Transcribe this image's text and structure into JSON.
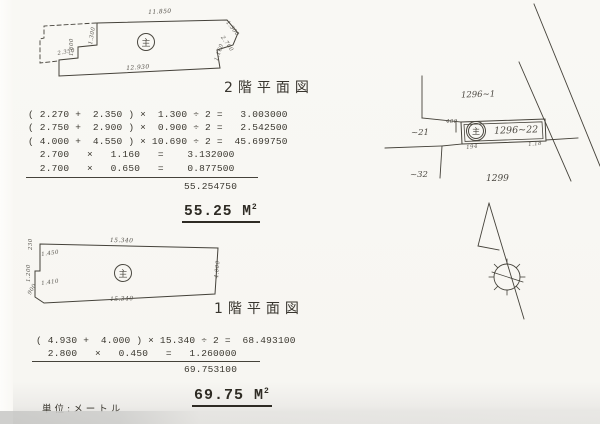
{
  "paper": {
    "bg": "#f8f7f3",
    "ink": "#45423a"
  },
  "plan_2f": {
    "title": "2階平面図",
    "circle_symbol": "主",
    "dim_top": "11.850",
    "dim_bottom": "12.930",
    "dim_left_steps": [
      "2.350",
      "1.600",
      "1.300"
    ],
    "dim_right": [
      "1.300",
      "2.700",
      "1.160"
    ]
  },
  "calc_2f": {
    "lines": [
      "( 2.270 +  2.350 ) ×  1.300 ÷ 2 =   3.003000",
      "( 2.750 +  2.900 ) ×  0.900 ÷ 2 =   2.542500",
      "( 4.000 +  4.550 ) × 10.690 ÷ 2 =  45.699750",
      "  2.700   ×   1.160   =    3.132000",
      "  2.700   ×   0.650   =    0.877500"
    ],
    "total": "55.254750",
    "area": "55.25 M",
    "area_sup": "2"
  },
  "plan_1f": {
    "title": "1階平面図",
    "circle_symbol": "主",
    "dim_top": "15.340",
    "dim_bottom": "15.340",
    "dim_right": "4.000",
    "dim_left_steps": [
      "230",
      "1.450",
      "1.200",
      "1.410",
      "900"
    ]
  },
  "calc_1f": {
    "lines": [
      "( 4.930 +  4.000 ) × 15.340 ÷ 2 =  68.493100",
      "  2.800   ×   0.450   =   1.260000"
    ],
    "total": "69.753100",
    "area": "69.75 M",
    "area_sup": "2"
  },
  "unit_note": "単位:メートル",
  "site_map": {
    "parcel_top": "1296~1",
    "parcel_left": "~21",
    "parcel_lower_left": "~32",
    "parcel_bottom": "1299",
    "building_label": "1296~22",
    "building_symbol": "主",
    "tick_left": "400",
    "tick_bottom_left": "194",
    "tick_bottom_right": "1.18"
  }
}
